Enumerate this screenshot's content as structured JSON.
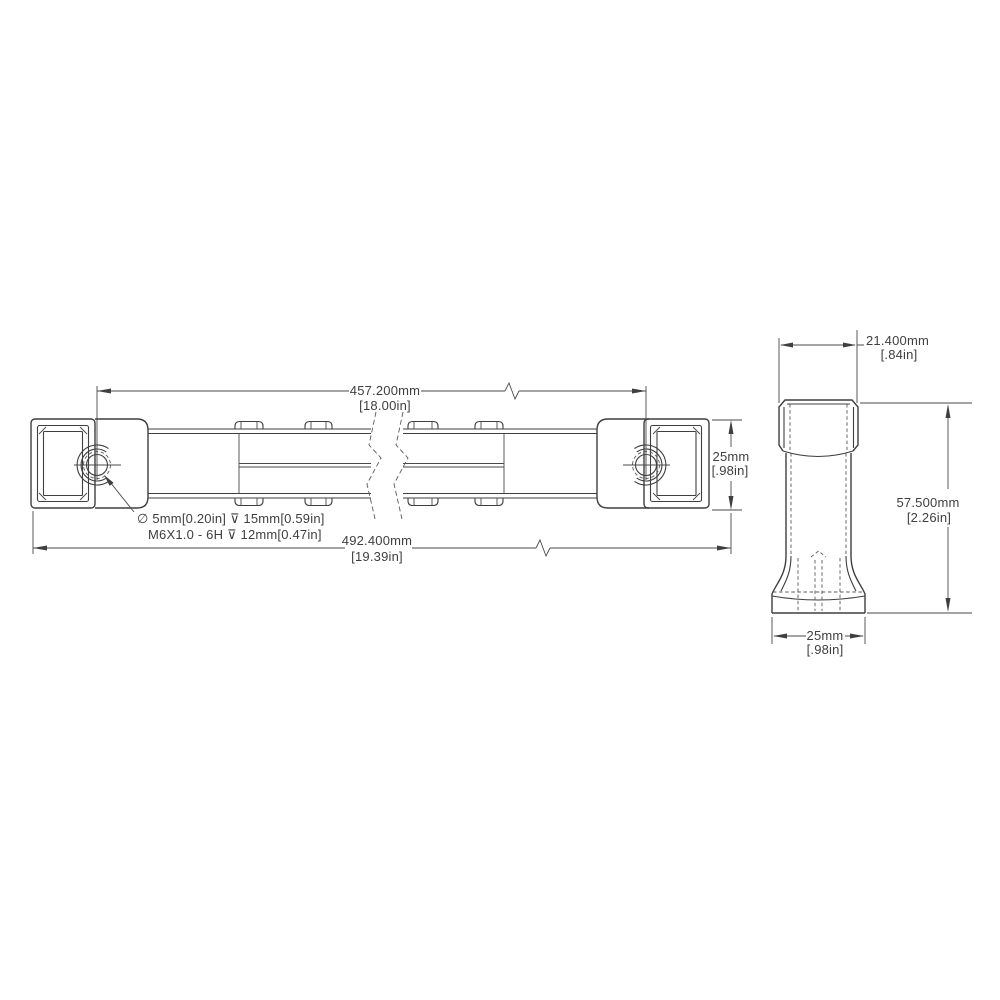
{
  "drawing": {
    "type": "engineering-dimension-drawing",
    "colors": {
      "background": "#ffffff",
      "line": "#3f3f3f",
      "text": "#3f3f3f"
    },
    "front_view": {
      "dimensions": {
        "hole_spacing": {
          "metric": "457.200mm",
          "imperial": "[18.00in]"
        },
        "overall_length": {
          "metric": "492.400mm",
          "imperial": "[19.39in]"
        },
        "rail_height": {
          "metric": "25mm",
          "imperial": "[.98in]"
        }
      },
      "hole_callout": {
        "line1": "∅ 5mm[0.20in] ⊽ 15mm[0.59in]",
        "line2": "M6X1.0 - 6H ⊽ 12mm[0.47in]"
      }
    },
    "side_view": {
      "dimensions": {
        "top_width": {
          "metric": "21.400mm",
          "imperial": "[.84in]"
        },
        "overall_height": {
          "metric": "57.500mm",
          "imperial": "[2.26in]"
        },
        "base_width": {
          "metric": "25mm",
          "imperial": "[.98in]"
        }
      }
    }
  }
}
